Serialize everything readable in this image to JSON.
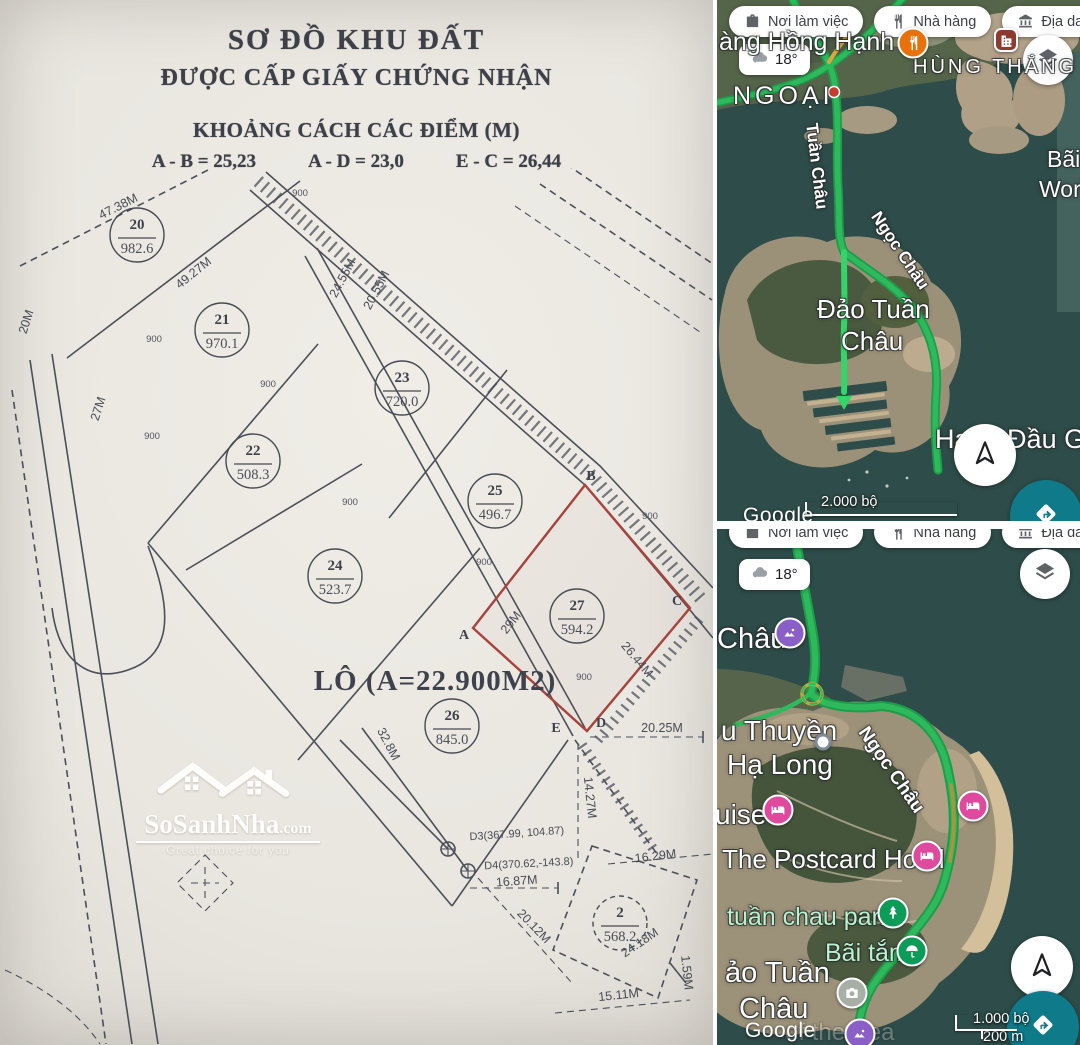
{
  "colors": {
    "paper": "#e9e6e0",
    "ink": "#4b4f59",
    "highlight_plot_red": "#a8423c",
    "water": "#2e4c49",
    "road_green": "#2fb95d",
    "fab_teal": "#0f7b8a",
    "hotel_pink": "#df4a9e",
    "attraction_purple": "#8a5fc7",
    "park_green": "#0d9b58",
    "restaurant_orange": "#e8710a"
  },
  "document": {
    "title_line1": "SƠ ĐỒ KHU ĐẤT",
    "title_line2": "ĐƯỢC CẤP GIẤY CHỨNG NHẬN",
    "subtitle": "KHOẢNG CÁCH CÁC ĐIỂM (M)",
    "distances": [
      "A - B = 25,23",
      "A - D = 23,0",
      "E - C = 26,44"
    ],
    "lot_note": "LÔ (A=22.900M2)",
    "plots": [
      {
        "id": "20",
        "area": "982.6",
        "x": 137,
        "y": 237
      },
      {
        "id": "21",
        "area": "970.1",
        "x": 222,
        "y": 332
      },
      {
        "id": "22",
        "area": "508.3",
        "x": 253,
        "y": 463
      },
      {
        "id": "23",
        "area": "720.0",
        "x": 402,
        "y": 390
      },
      {
        "id": "24",
        "area": "523.7",
        "x": 335,
        "y": 578
      },
      {
        "id": "25",
        "area": "496.7",
        "x": 495,
        "y": 503
      },
      {
        "id": "26",
        "area": "845.0",
        "x": 452,
        "y": 728
      },
      {
        "id": "27",
        "area": "594.2",
        "x": 577,
        "y": 618,
        "highlight": true
      },
      {
        "id": "2",
        "area": "568.2",
        "x": 620,
        "y": 925,
        "dashed": true
      }
    ],
    "boundary_points": [
      {
        "label": "A",
        "x": 464,
        "y": 641
      },
      {
        "label": "B",
        "x": 591,
        "y": 482
      },
      {
        "label": "C",
        "x": 677,
        "y": 607
      },
      {
        "label": "D",
        "x": 601,
        "y": 729
      },
      {
        "label": "E",
        "x": 556,
        "y": 734
      }
    ],
    "measurements": [
      {
        "t": "47.38M",
        "x": 120,
        "y": 212,
        "r": -27
      },
      {
        "t": "49.27M",
        "x": 196,
        "y": 278,
        "r": -39
      },
      {
        "t": "20M",
        "x": 30,
        "y": 325,
        "r": -72
      },
      {
        "t": "27M",
        "x": 102,
        "y": 412,
        "r": -72
      },
      {
        "t": "24.55M",
        "x": 346,
        "y": 282,
        "r": -62
      },
      {
        "t": "20.55M",
        "x": 380,
        "y": 294,
        "r": -62
      },
      {
        "t": "29M",
        "x": 514,
        "y": 627,
        "r": -52
      },
      {
        "t": "26.44M",
        "x": 634,
        "y": 664,
        "r": 50
      },
      {
        "t": "32.8M",
        "x": 385,
        "y": 748,
        "r": 62
      },
      {
        "t": "20.25M",
        "x": 662,
        "y": 734,
        "r": 0
      },
      {
        "t": "14.27M",
        "x": 586,
        "y": 800,
        "r": 84
      },
      {
        "t": "16.29M",
        "x": 656,
        "y": 862,
        "r": -7
      },
      {
        "t": "16.87M",
        "x": 517,
        "y": 887,
        "r": -4
      },
      {
        "t": "20.12M",
        "x": 531,
        "y": 931,
        "r": 46
      },
      {
        "t": "24.18M",
        "x": 642,
        "y": 948,
        "r": -34
      },
      {
        "t": "15.11M",
        "x": 619,
        "y": 1001,
        "r": -6
      },
      {
        "t": "1.59M",
        "x": 683,
        "y": 975,
        "r": 84
      },
      {
        "t": "D3(367.99, 104.87)",
        "x": 517,
        "y": 839,
        "r": -4,
        "s": 11
      },
      {
        "t": "D4(370.62,-143.8)",
        "x": 529,
        "y": 869,
        "r": -3,
        "s": 11
      }
    ],
    "angle_value": "900",
    "angle_marks": [
      [
        300,
        198
      ],
      [
        154,
        344
      ],
      [
        268,
        389
      ],
      [
        152,
        441
      ],
      [
        350,
        507
      ],
      [
        484,
        567
      ],
      [
        584,
        682
      ],
      [
        650,
        521
      ]
    ],
    "watermark": {
      "brand": "SoSanhNha",
      "suffix": ".com",
      "tagline": "Great choice for you"
    }
  },
  "maps": [
    {
      "name": "map-top",
      "chips": [
        {
          "icon": "briefcase",
          "label": "Nơi làm việc"
        },
        {
          "icon": "restaurant",
          "label": "Nhà hàng"
        },
        {
          "icon": "landmark",
          "label": "Địa danh"
        },
        {
          "icon": "hotel",
          "label": "Khách sạn"
        }
      ],
      "weather": "18°",
      "scale_primary": "2.000 bộ",
      "scale_secondary": "",
      "attribution": "Google",
      "labels": [
        {
          "t": "àng Hồng Hạnh 6",
          "x": 2,
          "y": 28,
          "s": 25
        },
        {
          "t": "HÙNG THẮNG",
          "x": 196,
          "y": 56,
          "s": 20,
          "ls": 3
        },
        {
          "t": "NGOẠI",
          "x": 16,
          "y": 82,
          "s": 25,
          "ls": 4
        },
        {
          "t": "Tuần Châu",
          "x": 104,
          "y": 122,
          "s": 17,
          "rot": 83,
          "cls": "road"
        },
        {
          "t": "Ngọc Châu",
          "x": 166,
          "y": 208,
          "s": 17,
          "rot": 56,
          "cls": "road"
        },
        {
          "t": "Đảo Tuần",
          "x": 100,
          "y": 294,
          "s": 26
        },
        {
          "t": "Châu",
          "x": 124,
          "y": 326,
          "s": 26
        },
        {
          "t": "Bãi",
          "x": 330,
          "y": 146,
          "s": 23
        },
        {
          "t": "World",
          "x": 322,
          "y": 176,
          "s": 23
        },
        {
          "t": "Hang Đầu G",
          "x": 218,
          "y": 424,
          "s": 27
        }
      ],
      "markers": [
        {
          "type": "restaurant",
          "x": 196,
          "y": 43
        },
        {
          "type": "building",
          "x": 289,
          "y": 40
        }
      ]
    },
    {
      "name": "map-bottom",
      "chips": [
        {
          "icon": "briefcase",
          "label": "Nơi làm việc"
        },
        {
          "icon": "restaurant",
          "label": "Nhà hàng"
        },
        {
          "icon": "landmark",
          "label": "Địa danh"
        },
        {
          "icon": "hotel",
          "label": "Khách sạn"
        }
      ],
      "weather": "18°",
      "scale_primary": "1.000 bộ",
      "scale_secondary": "200 m",
      "attribution": "Google",
      "labels": [
        {
          "t": "Châu",
          "x": 0,
          "y": 94,
          "s": 29
        },
        {
          "t": "Ngọc Châu",
          "x": 154,
          "y": 194,
          "s": 19,
          "rot": 55,
          "cls": "road"
        },
        {
          "t": "u Thuyền",
          "x": 4,
          "y": 186,
          "s": 28
        },
        {
          "t": "Hạ Long",
          "x": 10,
          "y": 220,
          "s": 28
        },
        {
          "t": "uise",
          "x": -2,
          "y": 270,
          "s": 28
        },
        {
          "t": "The Postcard Hotel",
          "x": 5,
          "y": 315,
          "s": 26
        },
        {
          "t": "tuần chau park",
          "x": 10,
          "y": 374,
          "s": 25,
          "cls": "park"
        },
        {
          "t": "Bãi tắm",
          "x": 108,
          "y": 410,
          "s": 25,
          "cls": "park"
        },
        {
          "t": "ảo Tuần",
          "x": 8,
          "y": 428,
          "s": 29
        },
        {
          "t": "Châu",
          "x": 22,
          "y": 464,
          "s": 29
        },
        {
          "t": "of the Sea",
          "x": 68,
          "y": 490,
          "s": 24,
          "cls": "ghost"
        }
      ],
      "markers": [
        {
          "type": "attraction",
          "x": 73,
          "y": 104
        },
        {
          "type": "poi",
          "x": 106,
          "y": 213
        },
        {
          "type": "hotel",
          "x": 61,
          "y": 281
        },
        {
          "type": "hotel",
          "x": 210,
          "y": 327
        },
        {
          "type": "hotel",
          "x": 256,
          "y": 277
        },
        {
          "type": "park",
          "x": 176,
          "y": 384
        },
        {
          "type": "beach",
          "x": 195,
          "y": 422
        },
        {
          "type": "camera",
          "x": 135,
          "y": 464
        },
        {
          "type": "attraction",
          "x": 143,
          "y": 505
        }
      ]
    }
  ]
}
